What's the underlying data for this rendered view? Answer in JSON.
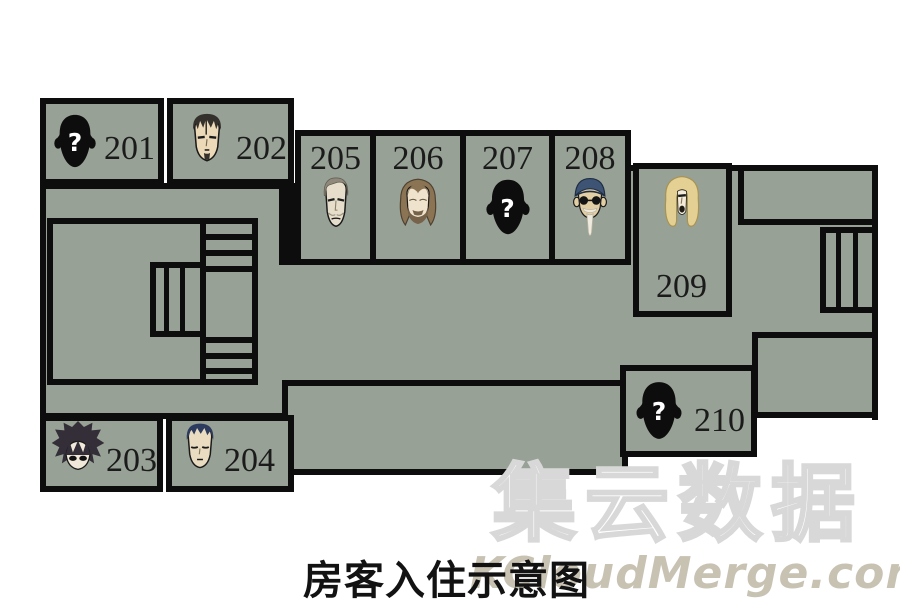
{
  "canvas": {
    "width": 900,
    "height": 610
  },
  "colors": {
    "room_fill": "#97a195",
    "wall": "#0d0d0d",
    "background": "#ffffff",
    "number_color": "#1b1b1b",
    "caption_color": "#121212",
    "watermark_cn_outline": "#d8d8d8",
    "watermark_en_color": "#c8c2b3"
  },
  "caption": {
    "text": "房客入住示意图"
  },
  "watermark": {
    "line1": "集云数据",
    "line2": "KCloudMerge.com"
  },
  "marks": {
    "question": "?"
  },
  "rooms": [
    {
      "number": "201",
      "avatar": "unknown-silhouette"
    },
    {
      "number": "202",
      "avatar": "man-slicked-dark-hair-goatee"
    },
    {
      "number": "203",
      "avatar": "man-shaggy-dark-hair"
    },
    {
      "number": "204",
      "avatar": "man-short-navy-hair"
    },
    {
      "number": "205",
      "avatar": "gaunt-man-gray-hair"
    },
    {
      "number": "206",
      "avatar": "man-long-brown-hair-beard"
    },
    {
      "number": "207",
      "avatar": "unknown-silhouette"
    },
    {
      "number": "208",
      "avatar": "old-man-blue-cap-glasses-white-goatee"
    },
    {
      "number": "209",
      "avatar": "man-long-blonde-hair"
    },
    {
      "number": "210",
      "avatar": "unknown-silhouette"
    }
  ]
}
